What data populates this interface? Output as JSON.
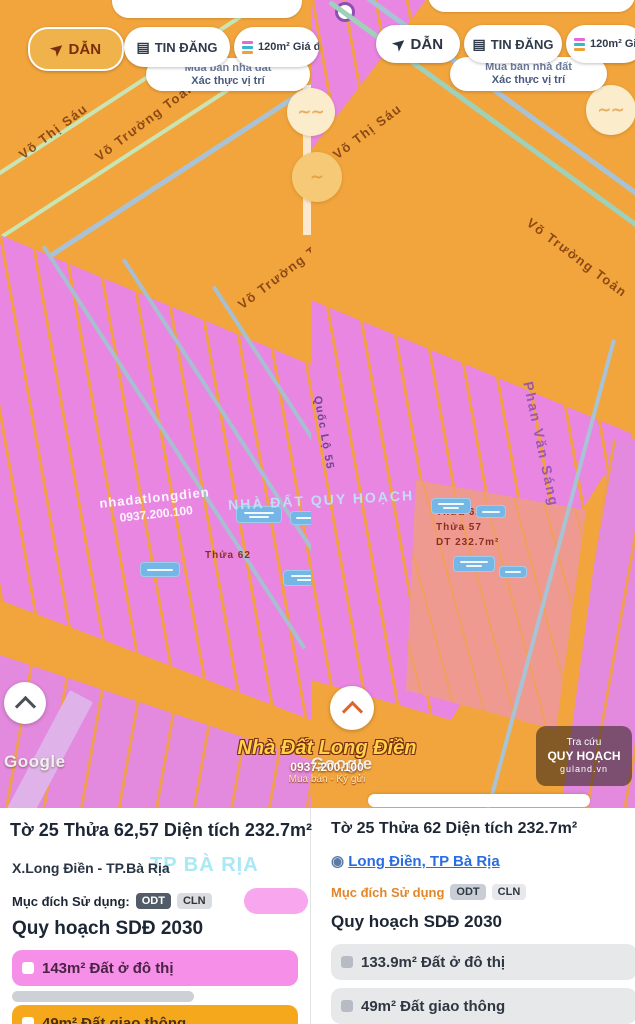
{
  "toolbar_left": {
    "nav": "DẪN",
    "listings": "TIN ĐĂNG",
    "layers": "120m² Giá đất",
    "banner1": "Mua bán nhà đất",
    "banner2": "Xác thực vị trí"
  },
  "toolbar_right": {
    "nav": "DẪN",
    "listings": "TIN ĐĂNG",
    "layers": "120m² Giá đất",
    "banner1": "Mua bán nhà đất",
    "banner2": "Xác thực vị trí"
  },
  "map": {
    "roads": {
      "r1": "Võ Thị Sáu",
      "r2": "Võ Trường Toản",
      "r3": "Võ Trường Toản",
      "r4": "Võ Thị Sáu",
      "r5": "Võ Trường Toản",
      "r6": "Phan Văn Sáng",
      "r7": "Quốc Lộ 55"
    },
    "annotations": {
      "a1": "Thửa 62",
      "a2": "Thửa 57",
      "a3": "DT 232.7m²",
      "a4": "Thửa 62"
    },
    "watermarks": {
      "google_left": "Google",
      "google_right": "Google",
      "white1": "nhadatlongdien",
      "white2": "0937.200.100",
      "cyan": "NHÀ ĐẤT QUY HOẠCH",
      "orange_title": "Nhà Đất Long Điền",
      "orange_phone": "0937.200.100",
      "orange_sub": "Mua bán - Ký gửi",
      "chip_line1": "Tra cứu",
      "chip_line2": "QUY HOẠCH",
      "chip_line3": "guland.vn"
    }
  },
  "sheet_left": {
    "title": "Tờ 25 Thửa 62,57 Diện tích 232.7m²",
    "location": "X.Long Điền - TP.Bà Rịa",
    "location_watermark": "TP BÀ RỊA",
    "purpose_label": "Mục đích Sử dụng:",
    "badge1": "ODT",
    "badge2": "CLN",
    "planning": "Quy hoạch SDĐ 2030",
    "chip1": "143m² Đất ở đô thị",
    "chip2": "49m² Đất giao thông"
  },
  "sheet_right": {
    "title": "Tờ 25 Thửa 62 Diện tích 232.7m²",
    "location": "Long Điền, TP Bà Rịa",
    "purpose_label": "Mục đích Sử dụng",
    "badge1": "ODT",
    "badge2": "CLN",
    "planning": "Quy hoạch SDĐ 2030",
    "chip1": "133.9m² Đất ở đô thị",
    "chip2": "49m² Đất giao thông"
  }
}
